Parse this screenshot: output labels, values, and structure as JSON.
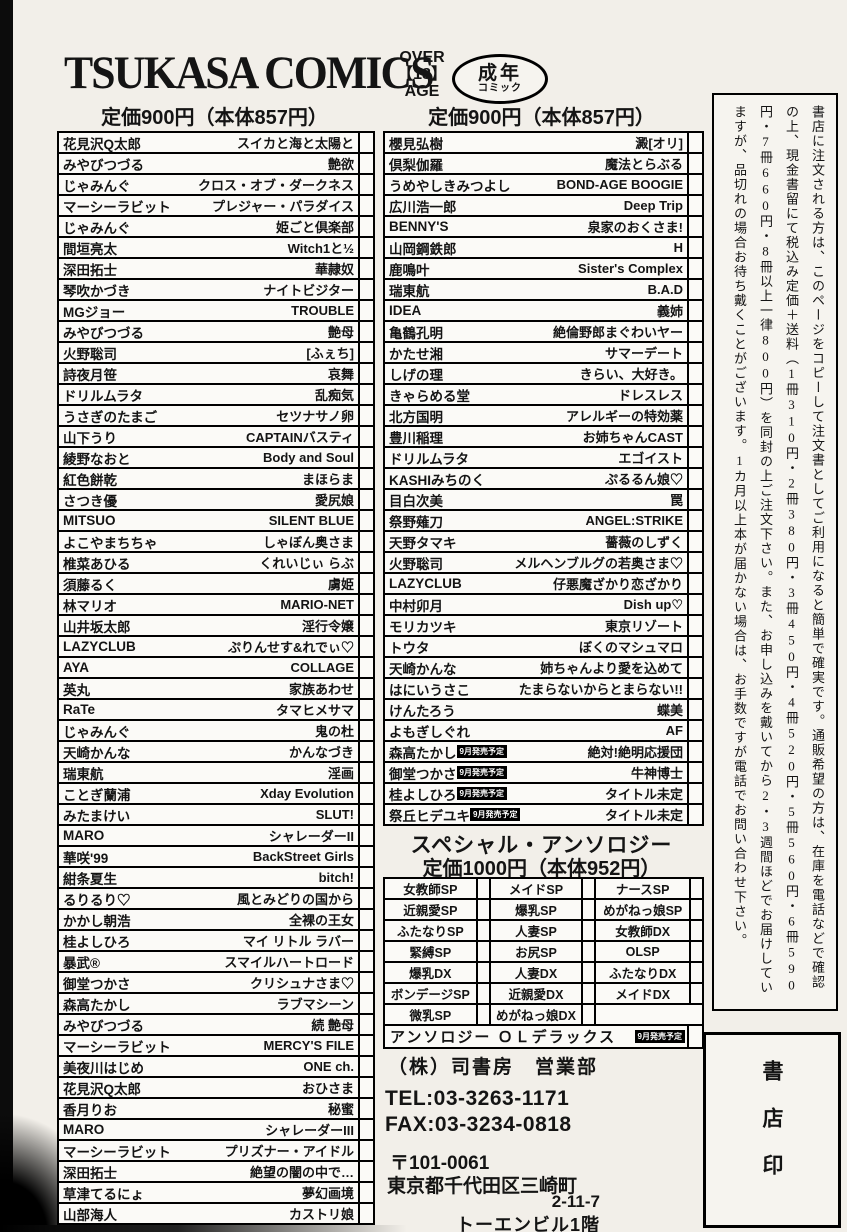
{
  "header": {
    "title": "TSUKASA COMICS",
    "age_restriction": {
      "line1": "OVER",
      "line2": "【18】",
      "line3": "AGE"
    },
    "adult_badge": {
      "line1": "成年",
      "line2": "コミック"
    }
  },
  "left_column": {
    "price": "定価900円（本体857円）",
    "rows": [
      {
        "author": "花見沢Q太郎",
        "title": "スイカと海と太陽と"
      },
      {
        "author": "みやびつづる",
        "title": "艶欲"
      },
      {
        "author": "じゃみんぐ",
        "title": "クロス・オブ・ダークネス"
      },
      {
        "author": "マーシーラビット",
        "title": "プレジャー・パラダイス"
      },
      {
        "author": "じゃみんぐ",
        "title": "姫ごと倶楽部"
      },
      {
        "author": "間垣亮太",
        "title": "Witch1と½"
      },
      {
        "author": "深田拓士",
        "title": "華隷奴"
      },
      {
        "author": "琴吹かづき",
        "title": "ナイトビジター"
      },
      {
        "author": "MGジョー",
        "title": "TROUBLE"
      },
      {
        "author": "みやびつづる",
        "title": "艶母"
      },
      {
        "author": "火野聡司",
        "title": "[ふぇち]"
      },
      {
        "author": "詩夜月笹",
        "title": "哀舞"
      },
      {
        "author": "ドリルムラタ",
        "title": "乱痴気"
      },
      {
        "author": "うさぎのたまご",
        "title": "セツナサノ卵"
      },
      {
        "author": "山下うり",
        "title": "CAPTAINバスティ"
      },
      {
        "author": "綾野なおと",
        "title": "Body and Soul"
      },
      {
        "author": "紅色餅乾",
        "title": "まほらま"
      },
      {
        "author": "さつき優",
        "title": "愛尻娘"
      },
      {
        "author": "MITSUO",
        "title": "SILENT BLUE"
      },
      {
        "author": "よこやまちちゃ",
        "title": "しゃぼん奥さま"
      },
      {
        "author": "椎菜あひる",
        "title": "くれいじぃ らぶ"
      },
      {
        "author": "須藤るく",
        "title": "虜姫"
      },
      {
        "author": "林マリオ",
        "title": "MARIO-NET"
      },
      {
        "author": "山井坂太郎",
        "title": "淫行令嬢"
      },
      {
        "author": "LAZYCLUB",
        "title": "ぷりんせす&れでぃ♡"
      },
      {
        "author": "AYA",
        "title": "COLLAGE"
      },
      {
        "author": "英丸",
        "title": "家族あわせ"
      },
      {
        "author": "RaTe",
        "title": "タマヒメサマ"
      },
      {
        "author": "じゃみんぐ",
        "title": "鬼の杜"
      },
      {
        "author": "天崎かんな",
        "title": "かんなづき"
      },
      {
        "author": "瑞東航",
        "title": "淫画"
      },
      {
        "author": "ことぎ蘭浦",
        "title": "Xday Evolution"
      },
      {
        "author": "みたまけい",
        "title": "SLUT!"
      },
      {
        "author": "MARO",
        "title": "シャレーダーII"
      },
      {
        "author": "華咲'99",
        "title": "BackStreet Girls"
      },
      {
        "author": "紺条夏生",
        "title": "bitch!"
      },
      {
        "author": "るりるり♡",
        "title": "風とみどりの国から"
      },
      {
        "author": "かかし朝浩",
        "title": "全裸の王女"
      },
      {
        "author": "桂よしひろ",
        "title": "マイ リトル ラバー"
      },
      {
        "author": "暴武®",
        "title": "スマイルハートロード"
      },
      {
        "author": "御堂つかさ",
        "title": "クリシュナさま♡"
      },
      {
        "author": "森高たかし",
        "title": "ラブマシーン"
      },
      {
        "author": "みやびつづる",
        "title": "続 艶母"
      },
      {
        "author": "マーシーラビット",
        "title": "MERCY'S FILE"
      },
      {
        "author": "美夜川はじめ",
        "title": "ONE ch."
      },
      {
        "author": "花見沢Q太郎",
        "title": "おひさま"
      },
      {
        "author": "香月りお",
        "title": "秘蜜"
      },
      {
        "author": "MARO",
        "title": "シャレーダーIII"
      },
      {
        "author": "マーシーラビット",
        "title": "プリズナー・アイドル"
      },
      {
        "author": "深田拓士",
        "title": "絶望の闇の中で…"
      },
      {
        "author": "草津てるにょ",
        "title": "夢幻画境"
      },
      {
        "author": "山部海人",
        "title": "カストリ娘"
      }
    ]
  },
  "right_column": {
    "price": "定価900円（本体857円）",
    "rows": [
      {
        "author": "櫻見弘樹",
        "title": "澱[オリ]"
      },
      {
        "author": "倶梨伽羅",
        "title": "魔法とらぶる"
      },
      {
        "author": "うめやしきみつよし",
        "title": "BOND-AGE BOOGIE"
      },
      {
        "author": "広川浩一郎",
        "title": "Deep Trip"
      },
      {
        "author": "BENNY'S",
        "title": "泉家のおくさま!"
      },
      {
        "author": "山岡鋼鉄郎",
        "title": "H"
      },
      {
        "author": "鹿鳴叶",
        "title": "Sister's Complex"
      },
      {
        "author": "瑞東航",
        "title": "B.A.D"
      },
      {
        "author": "IDEA",
        "title": "義姉"
      },
      {
        "author": "亀鶴孔明",
        "title": "絶倫野郎まぐわいヤー"
      },
      {
        "author": "かたせ湘",
        "title": "サマーデート"
      },
      {
        "author": "しげの理",
        "title": "きらい、大好き。"
      },
      {
        "author": "きゃらめる堂",
        "title": "ドレスレス"
      },
      {
        "author": "北方国明",
        "title": "アレルギーの特効薬"
      },
      {
        "author": "豊川稲理",
        "title": "お姉ちゃんCAST"
      },
      {
        "author": "ドリルムラタ",
        "title": "エゴイスト"
      },
      {
        "author": "KASHIみちのく",
        "title": "ぷるるん娘♡"
      },
      {
        "author": "目白次美",
        "title": "罠"
      },
      {
        "author": "祭野薙刀",
        "title": "ANGEL:STRIKE"
      },
      {
        "author": "天野タマキ",
        "title": "薔薇のしずく"
      },
      {
        "author": "火野聡司",
        "title": "メルヘンブルグの若奥さま♡"
      },
      {
        "author": "LAZYCLUB",
        "title": "仔悪魔ざかり恋ざかり"
      },
      {
        "author": "中村卯月",
        "title": "Dish up♡"
      },
      {
        "author": "モリカツキ",
        "title": "東京リゾート"
      },
      {
        "author": "トウタ",
        "title": "ぼくのマシュマロ"
      },
      {
        "author": "天崎かんな",
        "title": "姉ちゃんより愛を込めて"
      },
      {
        "author": "はにいうさこ",
        "title": "たまらないからとまらない!!"
      },
      {
        "author": "けんたろう",
        "title": "蝶美"
      },
      {
        "author": "よもぎしぐれ",
        "title": "AF"
      },
      {
        "author": "森高たかし",
        "badge": "9月発売予定",
        "title": "絶対!絶明応援団"
      },
      {
        "author": "御堂つかさ",
        "badge": "9月発売予定",
        "title": "牛神博士"
      },
      {
        "author": "桂よしひろ",
        "badge": "9月発売予定",
        "title": "タイトル未定"
      },
      {
        "author": "祭丘ヒデユキ",
        "badge": "9月発売予定",
        "title": "タイトル未定"
      }
    ]
  },
  "anthology": {
    "title": "スペシャル・アンソロジー",
    "price": "定価1000円（本体952円）",
    "cells": [
      "女教師SP",
      "メイドSP",
      "ナースSP",
      "近親愛SP",
      "爆乳SP",
      "めがねっ娘SP",
      "ふたなりSP",
      "人妻SP",
      "女教師DX",
      "緊縛SP",
      "お尻SP",
      "OLSP",
      "爆乳DX",
      "人妻DX",
      "ふたなりDX",
      "ボンデージSP",
      "近親愛DX",
      "メイドDX",
      "微乳SP",
      "めがねっ娘DX",
      ""
    ],
    "footer": {
      "label": "アンソロジー ＯＬデラックス",
      "badge": "9月発売予定"
    }
  },
  "publisher": {
    "company": "（株）司書房　営業部",
    "tel": "TEL:03-3263-1171",
    "fax": "FAX:03-3234-0818",
    "postal_code": "〒101-0061",
    "address_line1": "東京都千代田区三崎町",
    "address_line2": "2-11-7",
    "address_line3": "トーエンビル1階"
  },
  "sidebar": {
    "order_instructions": "書店に注文される方は、このページをコピーして注文書としてご利用になると簡単で確実です。通販希望の方は、在庫を電話などで確認の上、現金書留にて税込み定価＋送料（1冊310円・2冊380円・3冊450円・4冊520円・5冊560円・6冊590円・7冊660円・8冊以上一律800円）を同封の上ご注文下さい。また、お申し込みを戴いてから2・3週間ほどでお届けしていますが、品切れの場合お待ち戴くことがございます。1カ月以上本が届かない場合は、お手数ですが電話でお問い合わせ下さい。",
    "bookstore_stamp": "書店印"
  }
}
